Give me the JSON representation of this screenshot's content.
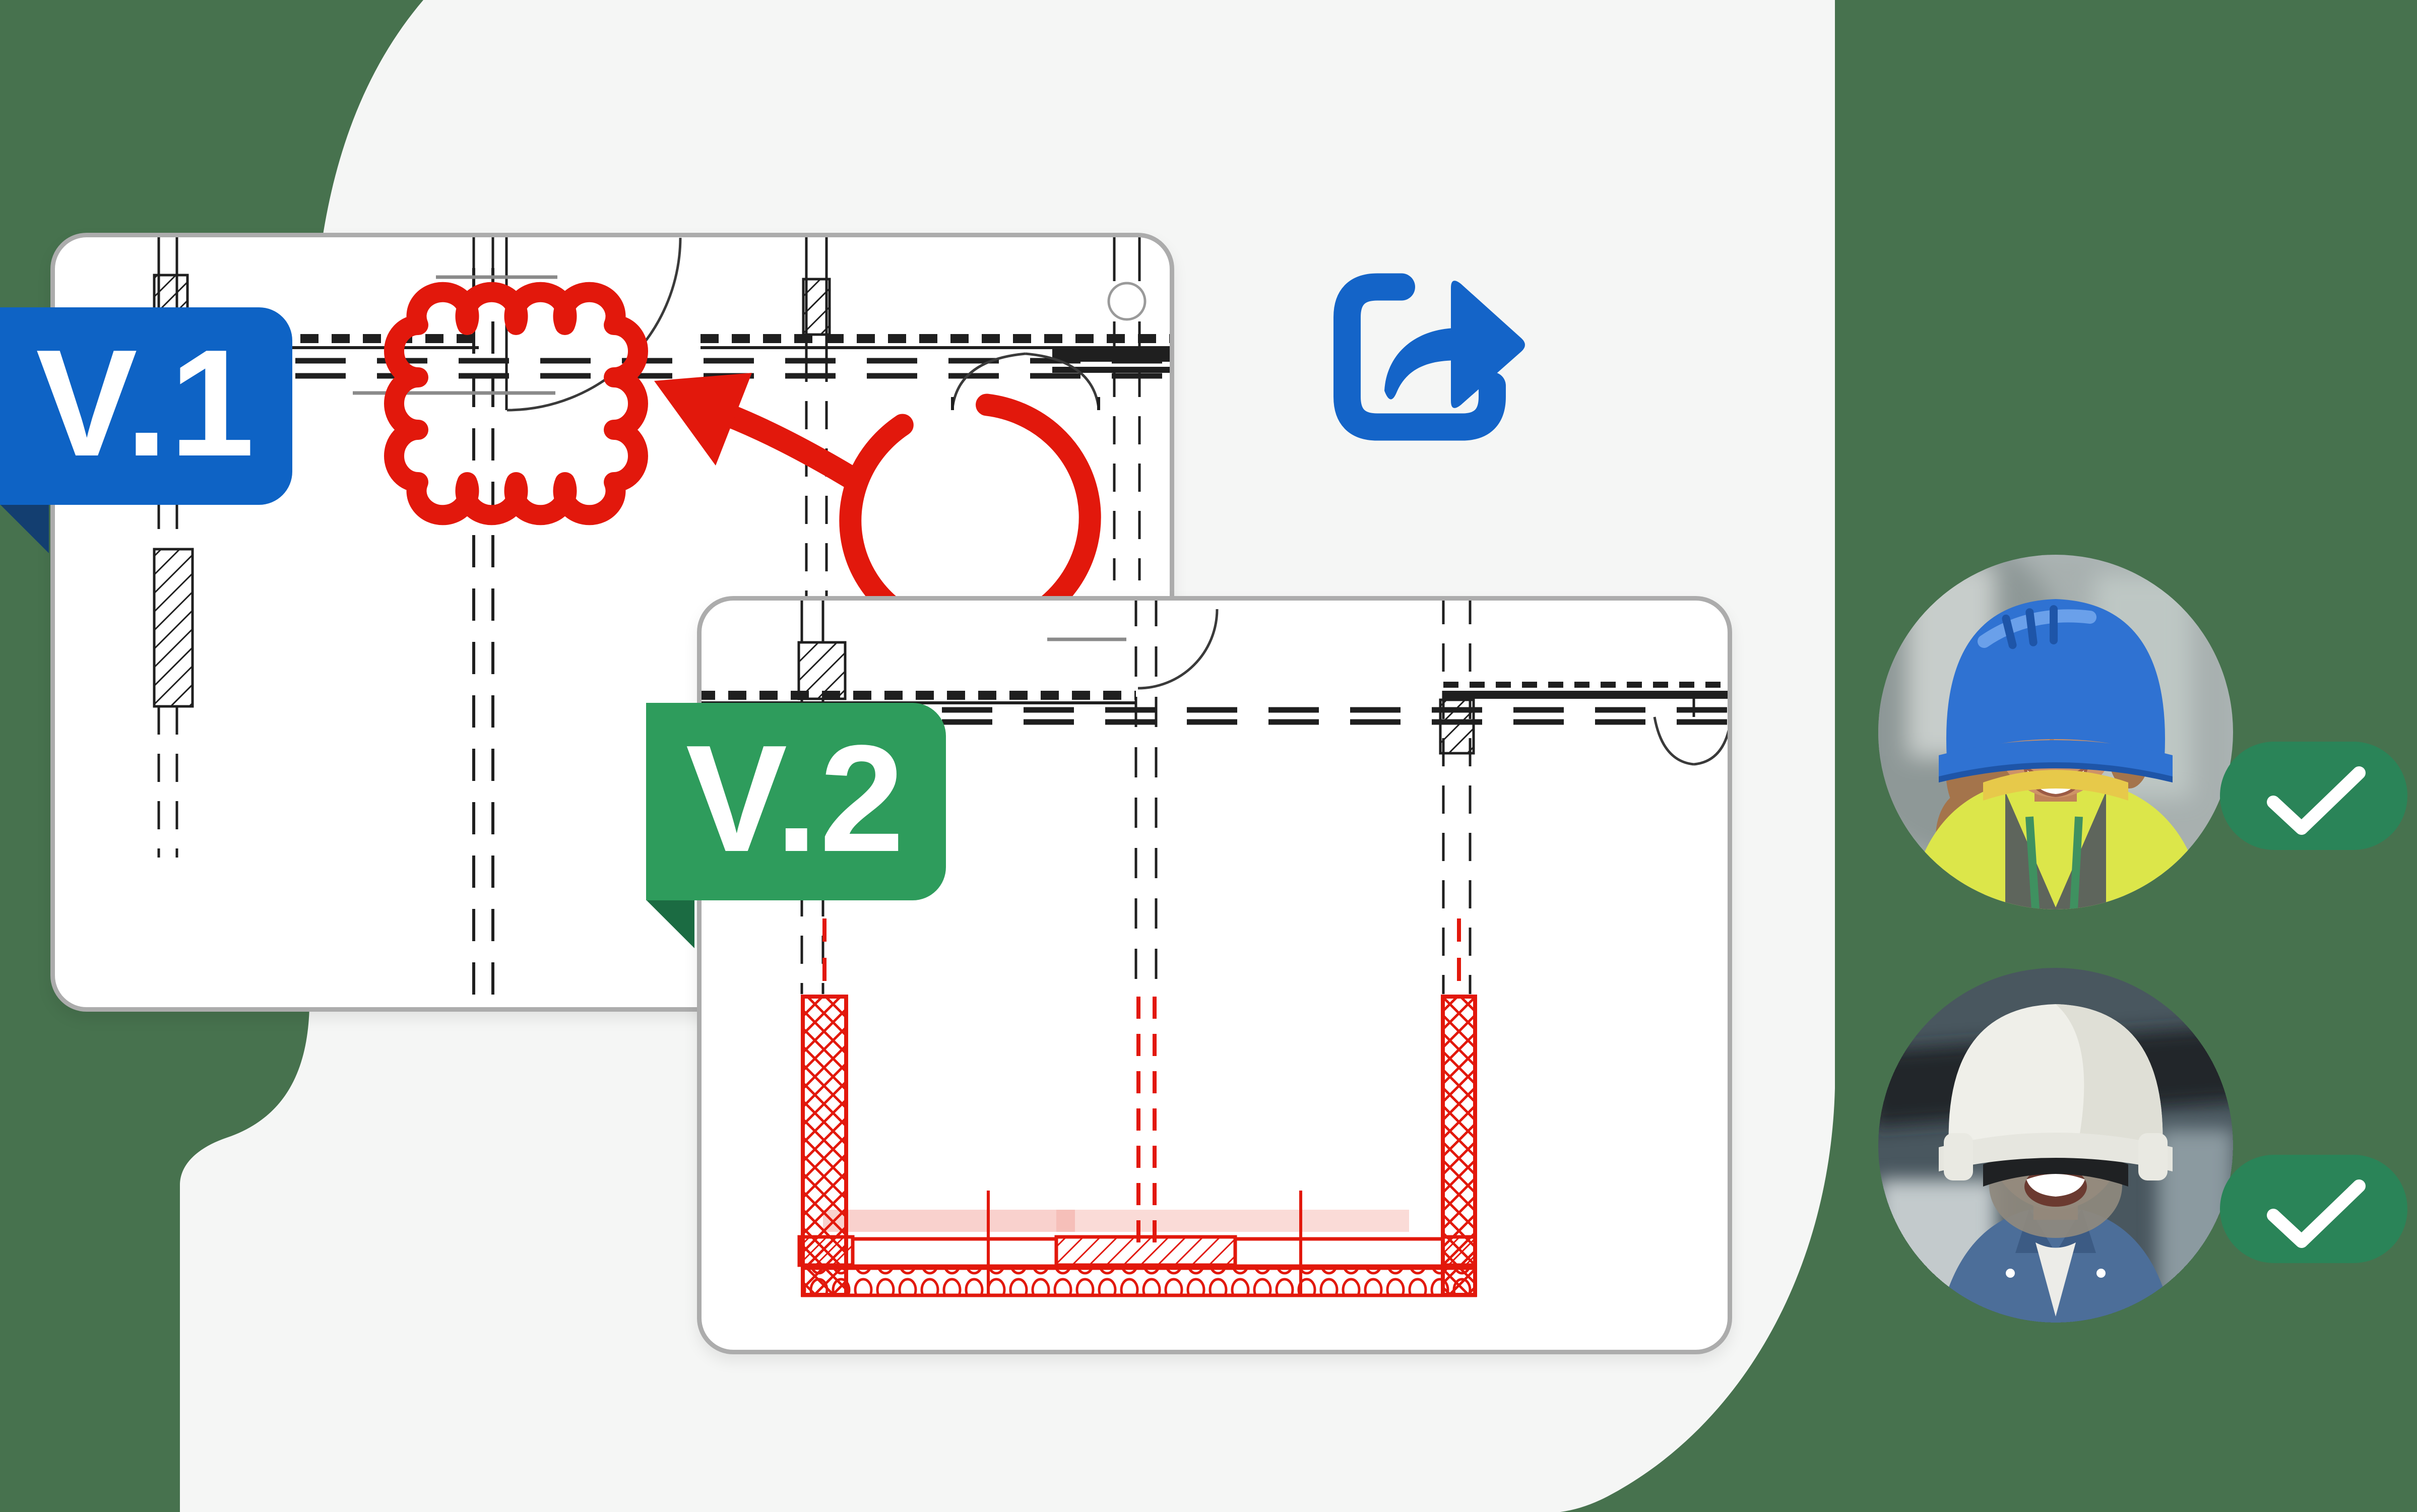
{
  "page": {
    "type": "floor-plan version collaboration illustration"
  },
  "background": {
    "page_color": "#47724E",
    "panel_color": "#F5F6F5"
  },
  "versions": [
    {
      "label": "V.1",
      "badge_color": "#0E63C5",
      "fold_color": "#133E70",
      "card": "floor-plan-version-1",
      "annotations": [
        "revision-cloud",
        "arrow",
        "circle-markup"
      ],
      "annotation_color": "#E2180C"
    },
    {
      "label": "V.2",
      "badge_color": "#2E9C5C",
      "fold_color": "#1B6B42",
      "card": "floor-plan-version-2",
      "annotations": [
        "red-highlighted-walls"
      ],
      "annotation_color": "#E2180C"
    }
  ],
  "share": {
    "icon": "share-forward-icon",
    "color": "#1464C8"
  },
  "collaborators": [
    {
      "avatar": "worker-with-blue-hard-hat",
      "status": "approved",
      "status_icon": "checkmark-icon",
      "status_color": "#2A8458"
    },
    {
      "avatar": "worker-with-white-hard-hat",
      "status": "approved",
      "status_icon": "checkmark-icon",
      "status_color": "#2A8458"
    }
  ],
  "card_style": {
    "background": "#FFFFFF",
    "border_color": "#ACACAC"
  }
}
